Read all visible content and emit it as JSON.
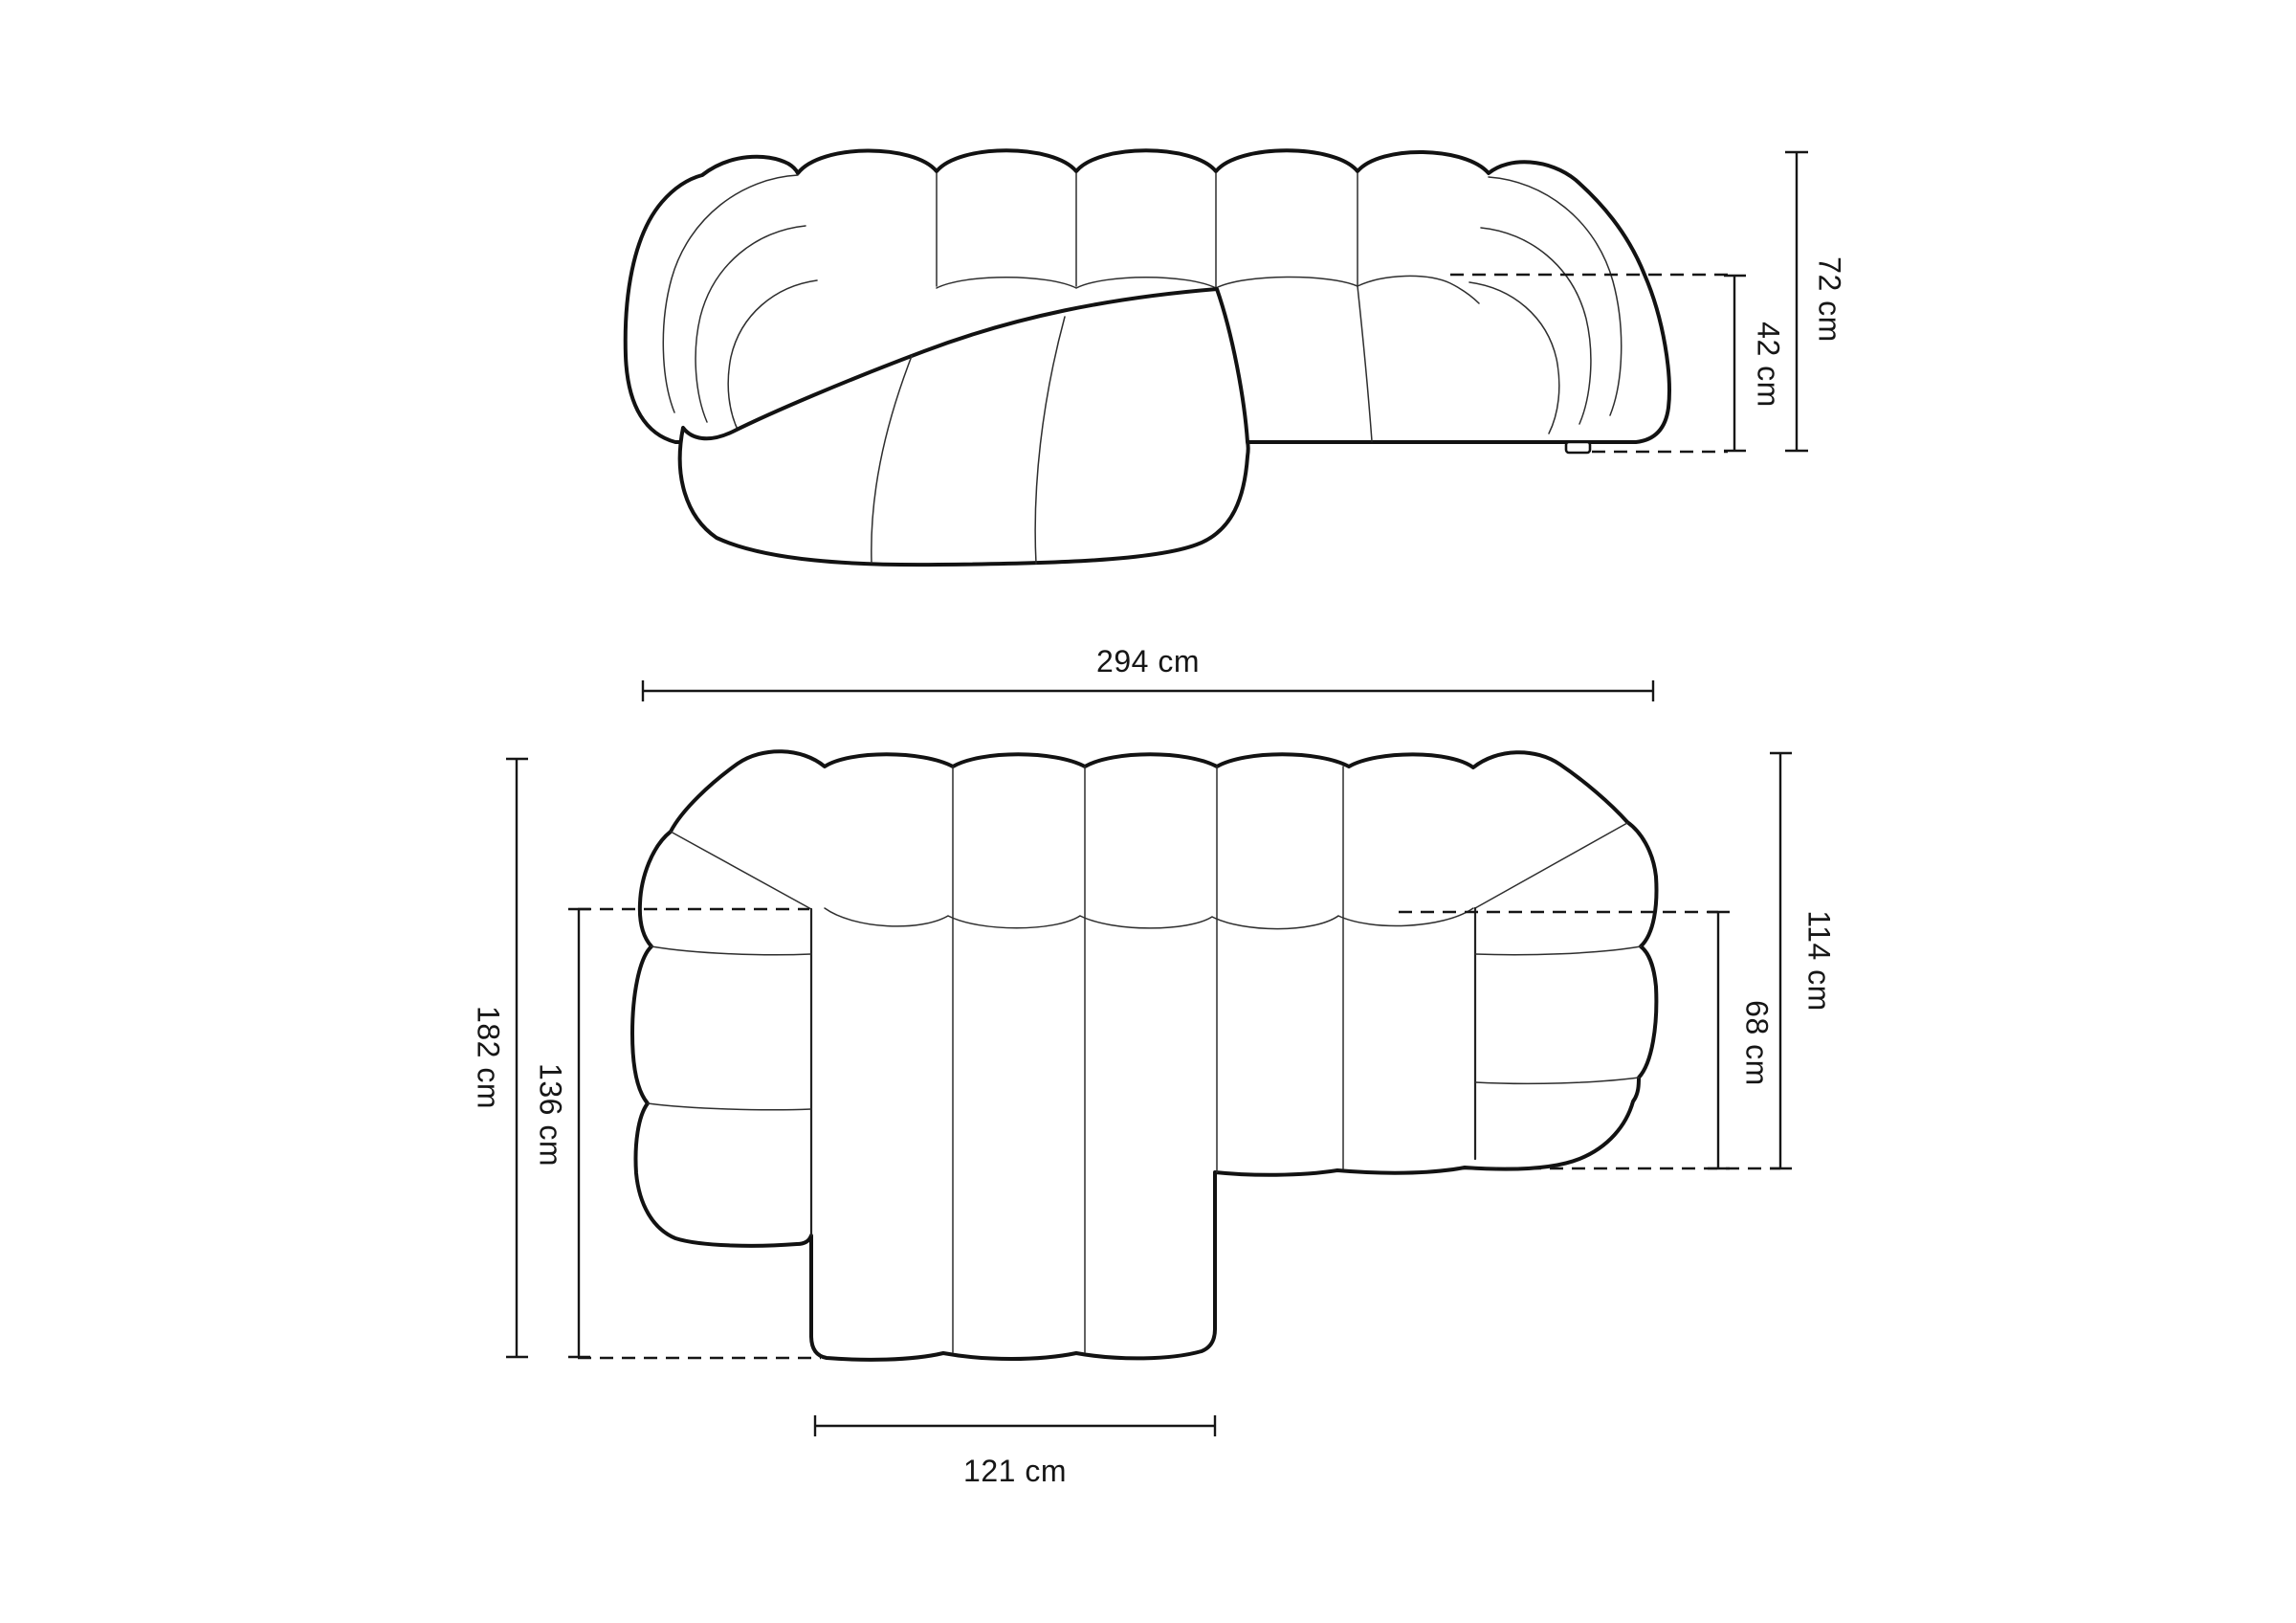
{
  "page": {
    "background": "#ffffff",
    "ink_color": "#161616",
    "content": "sofa-dimension-drawing"
  },
  "views": {
    "front_elevation": {
      "name": "front-elevation-view",
      "dims": {
        "total_height": "72 cm",
        "seat_height": "42 cm"
      }
    },
    "top_plan": {
      "name": "top-plan-view",
      "dims": {
        "total_width": "294 cm",
        "total_depth": "182 cm",
        "chaise_depth": "136 cm",
        "side_depth": "114 cm",
        "seat_depth": "68 cm",
        "chaise_width": "121 cm"
      }
    }
  }
}
